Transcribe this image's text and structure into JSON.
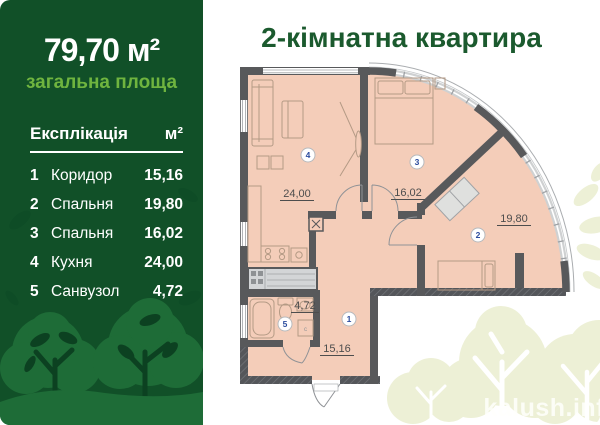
{
  "left_panel": {
    "total_area": "79,70 м²",
    "total_area_label": "загальна площа",
    "table": {
      "title": "Експлікація",
      "unit_header": "м²",
      "rows": [
        {
          "num": "1",
          "name": "Коридор",
          "area": "15,16"
        },
        {
          "num": "2",
          "name": "Спальня",
          "area": "19,80"
        },
        {
          "num": "3",
          "name": "Спальня",
          "area": "16,02"
        },
        {
          "num": "4",
          "name": "Кухня",
          "area": "24,00"
        },
        {
          "num": "5",
          "name": "Санвузол",
          "area": "4,72"
        }
      ]
    }
  },
  "plan_panel": {
    "title": "2-кімнатна квартира",
    "watermark": "kalush.inf",
    "rooms": [
      {
        "num": "1",
        "area": "15,16"
      },
      {
        "num": "2",
        "area": "19,80"
      },
      {
        "num": "3",
        "area": "16,02"
      },
      {
        "num": "4",
        "area": "24,00"
      },
      {
        "num": "5",
        "area": "4,72"
      }
    ]
  },
  "colors": {
    "background_green": "#115028",
    "accent_green": "#6fb43f",
    "title_green": "#1b5a2e",
    "tree_green": "#1e6c37",
    "tree_dark": "#0c4121",
    "room_fill": "#f4cdb9",
    "wall_gray": "#58595b",
    "badge_number_blue": "#2b4c9e",
    "pale_tree": "#edf0d6"
  }
}
